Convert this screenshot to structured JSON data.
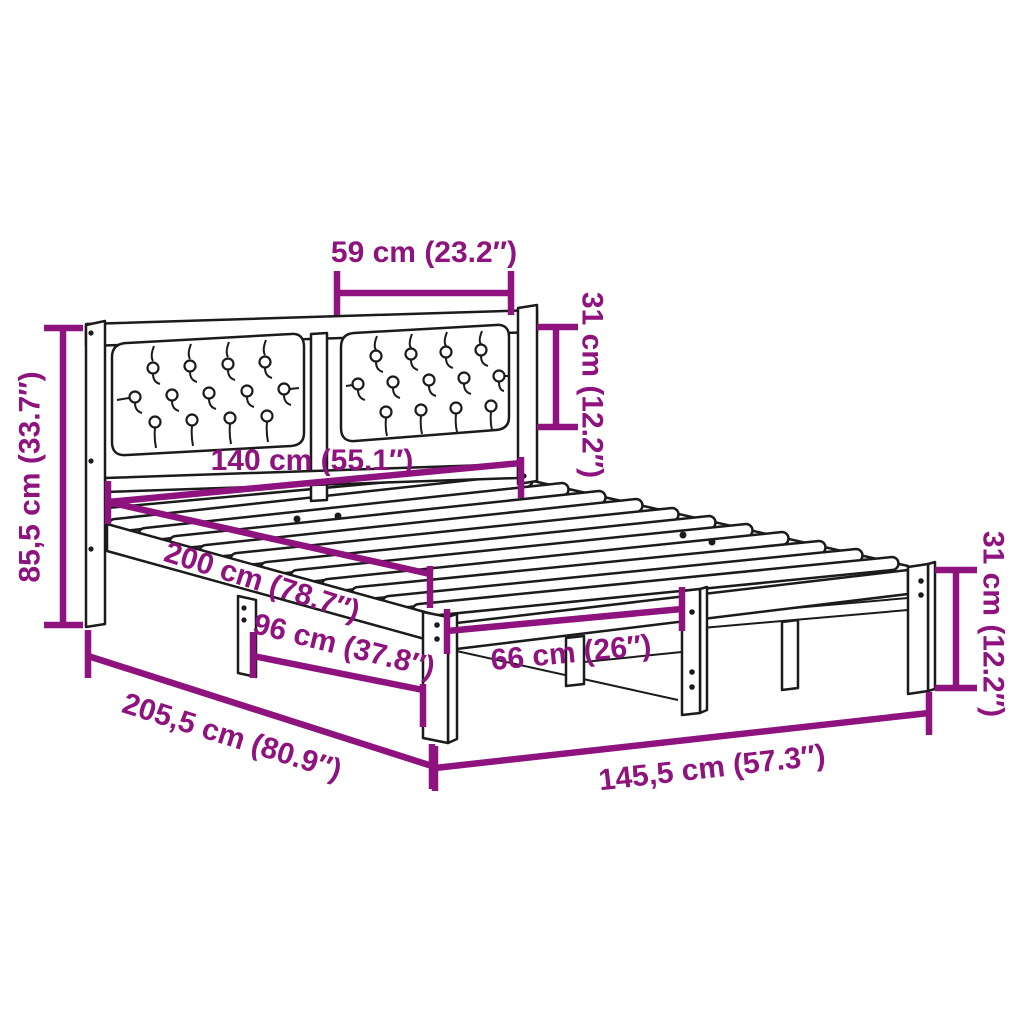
{
  "diagram": {
    "name": "bed-frame-dimension-diagram",
    "subject": "wooden bed frame with upholstered tufted headboard",
    "accent_color": "#8E137F",
    "line_color": "#1b1b1b",
    "background_color": "#ffffff"
  },
  "dimensions": {
    "cushion_width": "59 cm (23.2″)",
    "cushion_height": "31 cm (12.2″)",
    "headboard_width": "140 cm (55.1″)",
    "headboard_height": "85,5 cm (33.7″)",
    "inner_length": "200 cm (78.7″)",
    "side_leg_spacing": "96 cm (37.8″)",
    "total_length": "205,5 cm (80.9″)",
    "foot_leg_spacing": "66 cm (26″)",
    "total_width": "145,5 cm (57.3″)",
    "frame_height": "31 cm (12.2″)"
  }
}
